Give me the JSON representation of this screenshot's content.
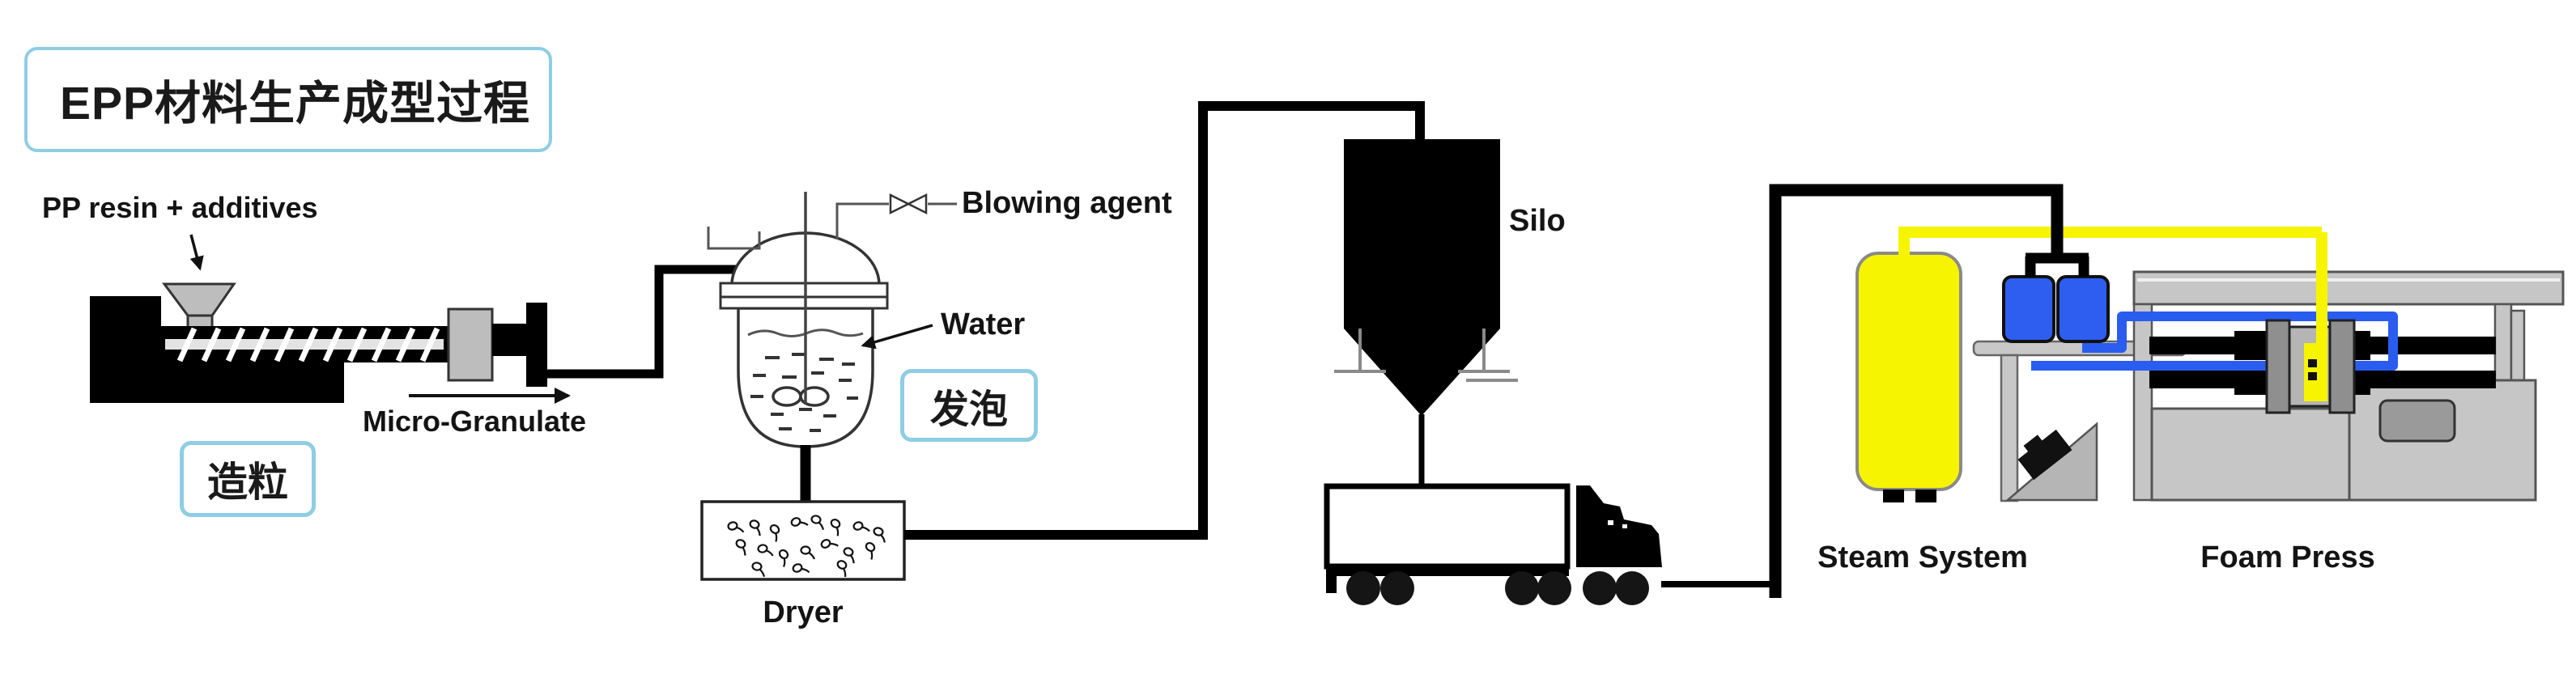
{
  "diagram_title": "EPP材料生产成型过程",
  "stages": {
    "granulation": "造粒",
    "foaming": "发泡"
  },
  "labels": {
    "pp_resin_additives": "PP resin + additives",
    "micro_granulate": "Micro-Granulate",
    "blowing_agent": "Blowing agent",
    "water": "Water",
    "dryer": "Dryer",
    "silo": "Silo",
    "steam_system": "Steam System",
    "foam_press": "Foam Press"
  },
  "colors": {
    "accent_border": "#8fcde4",
    "pipe_black": "#000000",
    "tank_yellow": "#f7f400",
    "steam_yellow": "#f7f400",
    "pipe_blue": "#2a5cf0",
    "valve_blue": "#2e5ef0",
    "machine_gray": "#c6c6c6"
  }
}
